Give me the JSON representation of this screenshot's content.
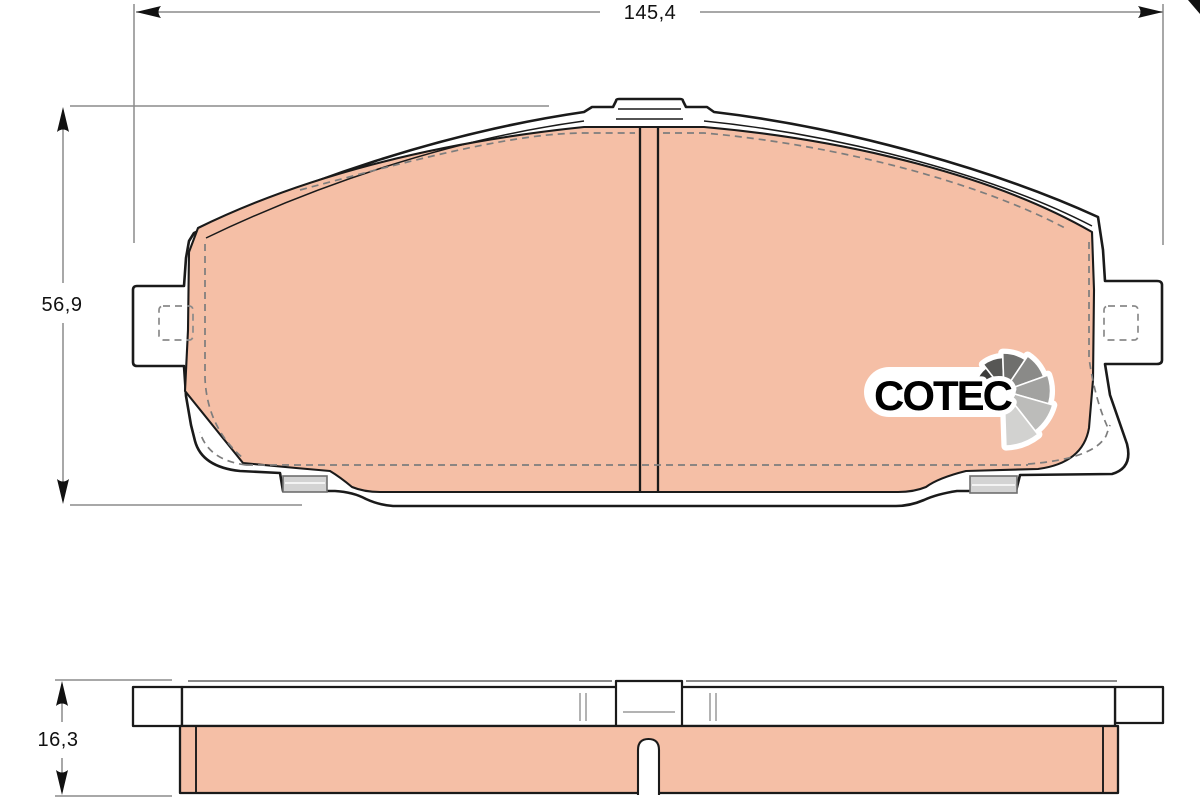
{
  "drawing": {
    "dimensions": {
      "width": {
        "label": "145,4"
      },
      "height": {
        "label": "56,9"
      },
      "thickness": {
        "label": "16,3"
      }
    },
    "logo": {
      "text": "COTEC",
      "text_color": "#1a1a1a",
      "halo_color": "#ffffff",
      "fan_colors": [
        "#1e1e1c",
        "#3c3c3a",
        "#575755",
        "#6f6f6d",
        "#8a8a88",
        "#a2a2a0",
        "#bcbcba",
        "#d2d2d0"
      ]
    },
    "colors": {
      "friction": "#f5bfa6",
      "outline": "#1a1a1a",
      "dimension_line": "#8c8c8c",
      "clip_tab": "#d3d3d3",
      "background": "#ffffff"
    }
  }
}
